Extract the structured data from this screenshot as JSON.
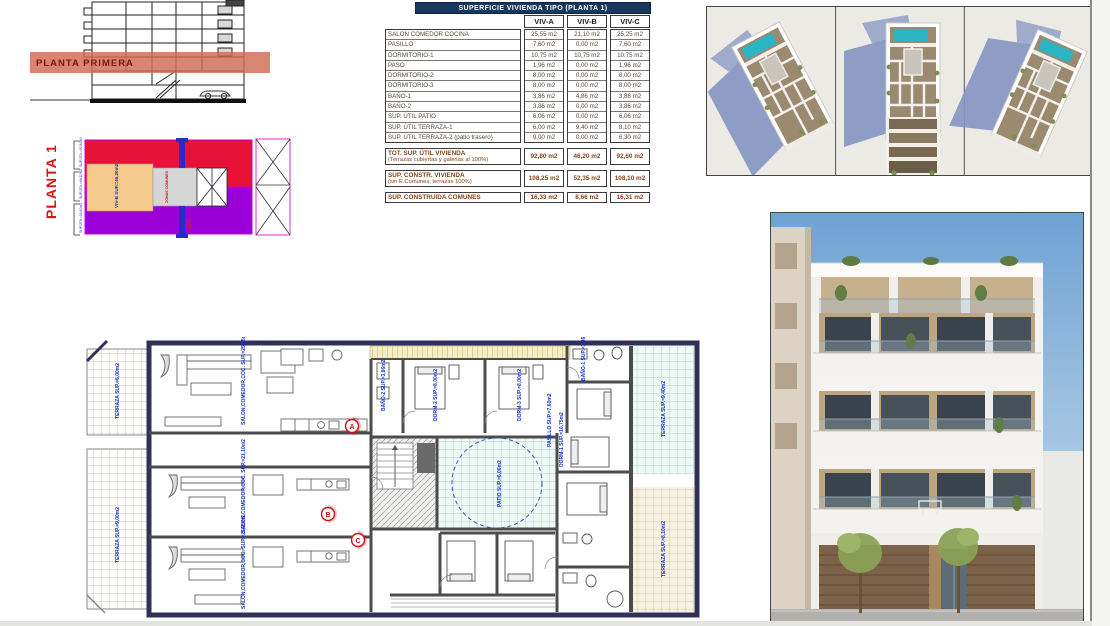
{
  "section_drawing": {
    "band_label": "PLANTA PRIMERA"
  },
  "key_plan": {
    "title": "PLANTA 1",
    "viv_b_block_label": "VIV-B SUP.=46,20m2",
    "common_label": "ZONAS COMUNES",
    "strip_top_label": "VIV-A",
    "strip_bottom_label": "VIV-C",
    "bracket_labels": [
      "SUP.ÚTIL=92,80m2",
      "SUP.ÚTIL=46,20m2",
      "SUP.ÚTIL=92,60m2"
    ],
    "colors": {
      "viv_a": "#e81238",
      "viv_b": "#f4c98c",
      "viv_c": "#9b00d8",
      "common": "#d6d6d6",
      "outline": "#cc00cc",
      "strip": "#2a2ac8"
    }
  },
  "table": {
    "title": "SUPERFICIE VIVIENDA TIPO (PLANTA 1)",
    "columns": [
      "VIV-A",
      "VIV-B",
      "VIV-C"
    ],
    "rows": [
      {
        "label": "SALON COMEDOR COCINA",
        "values": [
          "25,55 m2",
          "21,10 m2",
          "25,25 m2"
        ]
      },
      {
        "label": "PASILLO",
        "values": [
          "7,60 m2",
          "0,00 m2",
          "7,60 m2"
        ]
      },
      {
        "label": "DORMITORIO-1",
        "values": [
          "10,75 m2",
          "10,75 m2",
          "10,75 m2"
        ]
      },
      {
        "label": "PASO",
        "values": [
          "1,96 m2",
          "0,00 m2",
          "1,96 m2"
        ]
      },
      {
        "label": "DORMITORIO-2",
        "values": [
          "8,00 m2",
          "0,00 m2",
          "8,00 m2"
        ]
      },
      {
        "label": "DORMITORIO-3",
        "values": [
          "8,00 m2",
          "0,00 m2",
          "8,00 m2"
        ]
      },
      {
        "label": "BAÑO-1",
        "values": [
          "3,86 m2",
          "4,86 m2",
          "3,86 m2"
        ]
      },
      {
        "label": "BAÑO-2",
        "values": [
          "3,86 m2",
          "0,00 m2",
          "3,86 m2"
        ]
      },
      {
        "label": "SUP. ÚTIL PATIO",
        "values": [
          "6,06 m2",
          "0,00 m2",
          "6,06 m2"
        ]
      },
      {
        "label": "SUP. ÚTIL TERRAZA-1",
        "values": [
          "6,00 m2",
          "9,40 m2",
          "8,10 m2"
        ]
      },
      {
        "label": "SUP. ÚTIL TERRAZA-2 (patio trasero)",
        "values": [
          "9,00 m2",
          "0,00 m2",
          "6,30 m2"
        ]
      }
    ],
    "summary": [
      {
        "label": "TOT. SUP. ÚTIL VIVIENDA",
        "sublabel": "(Terrazas cubiertas y galerias al 100%)",
        "values": [
          "92,80 m2",
          "46,20 m2",
          "92,60 m2"
        ]
      },
      {
        "label": "SUP. CONSTR. VIVIENDA",
        "sublabel": "(sin E.Comunes, terrazas 100%)",
        "values": [
          "108,25 m2",
          "52,35 m2",
          "108,10 m2"
        ]
      },
      {
        "label": "SUP. CONSTRUIDA COMUNES",
        "sublabel": "",
        "values": [
          "16,33 m2",
          "8,66 m2",
          "16,31 m2"
        ]
      }
    ]
  },
  "floor_plan": {
    "labels": {
      "salon_a": "SALON,COMEDOR,COC. SUP.=25,55m2",
      "salon_b": "SALON,COMEDOR,COC. SUP.=21,10m2",
      "salon_c": "SALON,COMEDOR,COC. SUP.=25,25m2",
      "terraza_left_top": "TERRAZA SUP.=6,00m2",
      "terraza_left_bottom": "TERRAZA SUP.=9,00m2",
      "terraza_right_top": "TERRAZA SUP.=9,40m2",
      "terraza_right_bottom": "TERRAZA SUP.=8,10m2",
      "dorm1": "DORM-1 SUP.=10,75m2",
      "dorm2": "DORM-2 SUP.=8,00m2",
      "dorm3": "DORM-3 SUP.=8,00m2",
      "banyo1": "BAÑO-1 SUP.=3,86m2",
      "banyo2": "BAÑO-2 SUP.=3,86m2",
      "patio": "PATIO SUP.=6,06m2",
      "pasillo": "PASILLO SUP.=7,60m2"
    },
    "section_markers": {
      "a": "A",
      "b": "B",
      "c": "C"
    }
  },
  "colors": {
    "table_header": "#17375e",
    "section_band": "#d06a52",
    "plan_label_blue": "#1133cc",
    "pool_teal": "#2ab4c4",
    "sky_blue": "#7ba9d6"
  }
}
